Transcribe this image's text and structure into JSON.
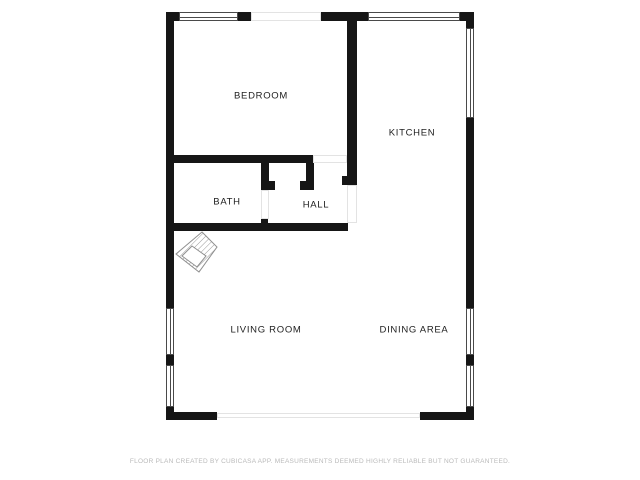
{
  "disclaimer": "FLOOR PLAN CREATED BY CUBICASA APP. MEASUREMENTS DEEMED HIGHLY RELIABLE BUT NOT GUARANTEED.",
  "colors": {
    "wall": "#161616",
    "window_frame": "#4a4a4a",
    "opening_line": "#e3e3e3",
    "label_text": "#212121",
    "disclaimer_text": "#bababa",
    "compass_stroke": "#8f8f8f",
    "background": "#ffffff"
  },
  "floorplan": {
    "rooms": [
      {
        "id": "bedroom",
        "label": "BEDROOM",
        "cx": 261,
        "cy": 96
      },
      {
        "id": "kitchen",
        "label": "KITCHEN",
        "cx": 412,
        "cy": 133
      },
      {
        "id": "bath",
        "label": "BATH",
        "cx": 227,
        "cy": 202
      },
      {
        "id": "hall",
        "label": "HALL",
        "cx": 316,
        "cy": 205
      },
      {
        "id": "living-room",
        "label": "LIVING ROOM",
        "cx": 266,
        "cy": 330
      },
      {
        "id": "dining-area",
        "label": "DINING AREA",
        "cx": 414,
        "cy": 330
      }
    ],
    "walls": [
      {
        "id": "left-wall-upper",
        "x": 166,
        "y": 12,
        "w": 8,
        "h": 296
      },
      {
        "id": "left-wall-window-divider",
        "x": 166,
        "y": 355,
        "w": 8,
        "h": 10
      },
      {
        "id": "left-wall-bottom-corner",
        "x": 166,
        "y": 407,
        "w": 8,
        "h": 13
      },
      {
        "id": "top-wall-left-corner",
        "x": 166,
        "y": 12,
        "w": 13,
        "h": 9
      },
      {
        "id": "top-wall-segment-1",
        "x": 238,
        "y": 12,
        "w": 13,
        "h": 9
      },
      {
        "id": "top-wall-segment-2",
        "x": 321,
        "y": 12,
        "w": 47,
        "h": 9
      },
      {
        "id": "top-wall-right-corner",
        "x": 460,
        "y": 12,
        "w": 14,
        "h": 9
      },
      {
        "id": "right-wall-top-corner",
        "x": 466,
        "y": 12,
        "w": 8,
        "h": 16
      },
      {
        "id": "right-wall-main",
        "x": 466,
        "y": 118,
        "w": 8,
        "h": 190
      },
      {
        "id": "right-wall-window-divider",
        "x": 466,
        "y": 355,
        "w": 8,
        "h": 10
      },
      {
        "id": "right-wall-bottom-corner",
        "x": 466,
        "y": 407,
        "w": 8,
        "h": 13
      },
      {
        "id": "bottom-wall-left",
        "x": 166,
        "y": 412,
        "w": 51,
        "h": 8
      },
      {
        "id": "bottom-wall-right",
        "x": 420,
        "y": 412,
        "w": 54,
        "h": 8
      },
      {
        "id": "bedroom-bottom-wall",
        "x": 166,
        "y": 155,
        "w": 147,
        "h": 8
      },
      {
        "id": "bedroom-kitchen-divider",
        "x": 347,
        "y": 21,
        "w": 10,
        "h": 164
      },
      {
        "id": "divider-door-jamb",
        "x": 342,
        "y": 176,
        "w": 5,
        "h": 9
      },
      {
        "id": "bath-hall-stub",
        "x": 261,
        "y": 163,
        "w": 8,
        "h": 27
      },
      {
        "id": "bath-hall-stub-jamb",
        "x": 269,
        "y": 181,
        "w": 6,
        "h": 9
      },
      {
        "id": "hall-closet-stub",
        "x": 306,
        "y": 163,
        "w": 8,
        "h": 27
      },
      {
        "id": "hall-closet-stub-jamb",
        "x": 300,
        "y": 181,
        "w": 6,
        "h": 9
      },
      {
        "id": "hall-bottom-wall",
        "x": 166,
        "y": 223,
        "w": 182,
        "h": 8
      },
      {
        "id": "bath-door-jamb-bump",
        "x": 261,
        "y": 219,
        "w": 7,
        "h": 4
      }
    ],
    "windows": [
      {
        "id": "top-window-bedroom",
        "x": 179,
        "y": 12,
        "w": 59,
        "h": 9,
        "orient": "h"
      },
      {
        "id": "top-window-kitchen",
        "x": 368,
        "y": 12,
        "w": 92,
        "h": 9,
        "orient": "h"
      },
      {
        "id": "right-window-kitchen",
        "x": 466,
        "y": 28,
        "w": 8,
        "h": 90,
        "orient": "v"
      },
      {
        "id": "left-window-living-1",
        "x": 166,
        "y": 308,
        "w": 8,
        "h": 47,
        "orient": "v"
      },
      {
        "id": "left-window-living-2",
        "x": 166,
        "y": 365,
        "w": 8,
        "h": 42,
        "orient": "v"
      },
      {
        "id": "right-window-dining-1",
        "x": 466,
        "y": 308,
        "w": 8,
        "h": 47,
        "orient": "v"
      },
      {
        "id": "right-window-dining-2",
        "x": 466,
        "y": 365,
        "w": 8,
        "h": 42,
        "orient": "v"
      }
    ],
    "openings": [
      {
        "id": "top-wall-opening",
        "x": 251,
        "y": 12,
        "w": 70,
        "h": 9
      },
      {
        "id": "bottom-wall-opening",
        "x": 217,
        "y": 413,
        "w": 203,
        "h": 5
      },
      {
        "id": "bedroom-door-opening",
        "x": 313,
        "y": 155,
        "w": 34,
        "h": 8
      },
      {
        "id": "bath-door-opening",
        "x": 261,
        "y": 190,
        "w": 8,
        "h": 29
      },
      {
        "id": "hall-kitchen-opening",
        "x": 347,
        "y": 185,
        "w": 10,
        "h": 38
      }
    ],
    "compass": {
      "x": 173,
      "y": 229,
      "size": 46
    }
  }
}
